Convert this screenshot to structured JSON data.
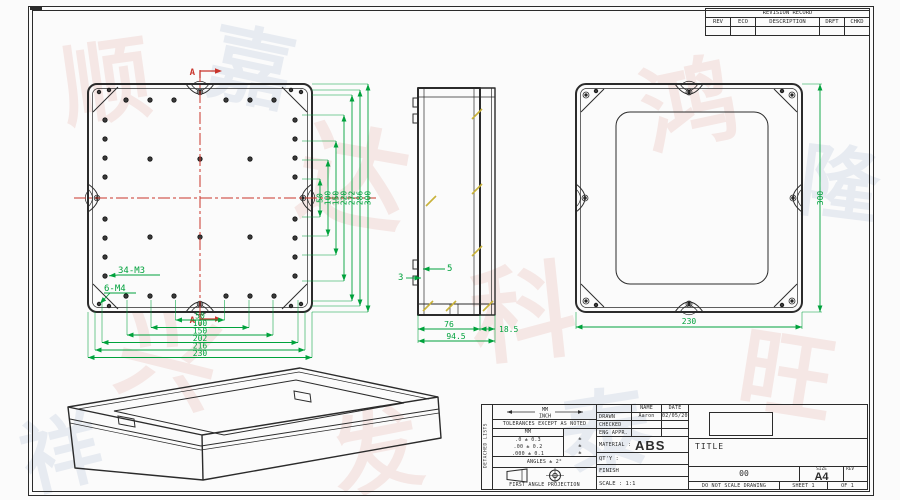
{
  "colors": {
    "dimension_green": "#00A23C",
    "centerline_red": "#C9342B",
    "drawing_line": "#2B2B2B",
    "boss_yellow": "#C9B23A"
  },
  "revision_table": {
    "title": "REVISION RECORD",
    "columns": [
      "REV",
      "ECO",
      "DESCRIPTION",
      "DRFT",
      "CHKD"
    ]
  },
  "front_view": {
    "section_letter_top": "A",
    "section_letter_bottom": "A",
    "thread_label_m3": "34-M3",
    "thread_label_m4": "6-M4",
    "h_dims": [
      "50",
      "100",
      "150",
      "202",
      "216",
      "230"
    ],
    "v_dims": [
      "50",
      "100",
      "150",
      "220",
      "272",
      "286",
      "300"
    ]
  },
  "side_view": {
    "dim_3": "3",
    "dim_5": "5",
    "depth_body": "76",
    "depth_lid": "18.5",
    "depth_total": "94.5"
  },
  "back_view": {
    "width": "230",
    "height": "300"
  },
  "title_block": {
    "side_label": "DETACHED LISTS",
    "tolerance": {
      "units_top": "MM",
      "units_bottom": "INCH",
      "note": "TOLERANCES EXCEPT AS NOTED",
      "col_header": "MM",
      "rows": [
        ".0 ± 0.3",
        ".00 ± 0.2",
        ".000 ± 0.1"
      ],
      "row_marks": [
        "±",
        "±",
        "±"
      ],
      "angles": "ANGLES ± 2°",
      "projection": "FIRST ANGLE PROJECTION"
    },
    "approvals": {
      "name_header": "NAME",
      "date_header": "DATE",
      "drawn_label": "DRAWN",
      "drawn_name": "Aaron",
      "drawn_date": "02/05/2015",
      "checked_label": "CHECKED",
      "eng_appr_label": "ENG APPR."
    },
    "material_label": "MATERIAL :",
    "material_value": "ABS",
    "qty_label": "QT'Y :",
    "finish_label": "FINISH",
    "scale_label": "SCALE : 1:1",
    "title_label": "TITLE",
    "drawing_number": "00",
    "size_label": "SIZE",
    "size_value": "A4",
    "rev_label": "REV",
    "do_not_scale": "DO NOT SCALE DRAWING",
    "sheet_label": "SHEET 1",
    "of_label": "OF 1"
  },
  "watermark": {
    "pink_glyphs": [
      "顺",
      "达",
      "鸿",
      "兴",
      "科",
      "旺",
      "发"
    ],
    "blue_glyphs": [
      "嘉",
      "泰",
      "隆",
      "祥"
    ]
  }
}
